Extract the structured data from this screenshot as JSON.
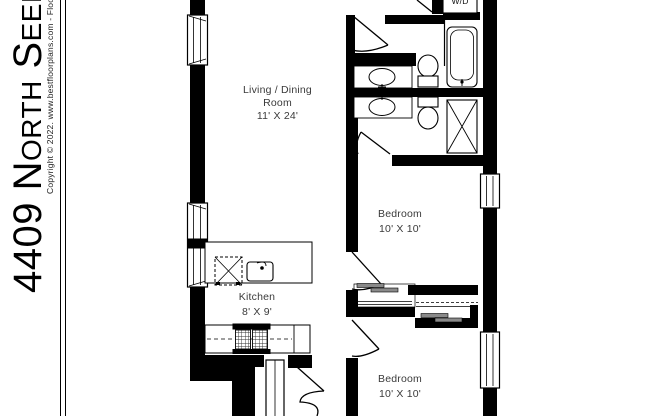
{
  "page": {
    "background": "#ffffff",
    "wall_color": "#000000",
    "label_color": "#3a3a3a",
    "closet_rod_color": "#8a8a8a"
  },
  "sidebar": {
    "title": "4409 North Seeley Avenue",
    "copyright": "Copyright © 2022. www.bestfloorplans.com - Floorplan"
  },
  "rooms": {
    "living": {
      "line1": "Living / Dining",
      "line2": "Room",
      "dims": "11' X 24'"
    },
    "kitchen": {
      "name": "Kitchen",
      "dims": "8' X 9'"
    },
    "bedroom1": {
      "name": "Bedroom",
      "dims": "10' X 10'"
    },
    "bedroom2": {
      "name": "Bedroom",
      "dims": "10' X 10'"
    }
  },
  "labels": {
    "washer_dryer": "W/D"
  },
  "fixtures": [
    "bathtub",
    "shower-stall",
    "toilet",
    "toilet",
    "vanity-sink",
    "vanity-sink",
    "kitchen-island",
    "kitchen-sink",
    "dishwasher",
    "stove",
    "washer-dryer",
    "closet-sliding-doors",
    "closet-sliding-doors",
    "window",
    "window",
    "window",
    "window"
  ]
}
